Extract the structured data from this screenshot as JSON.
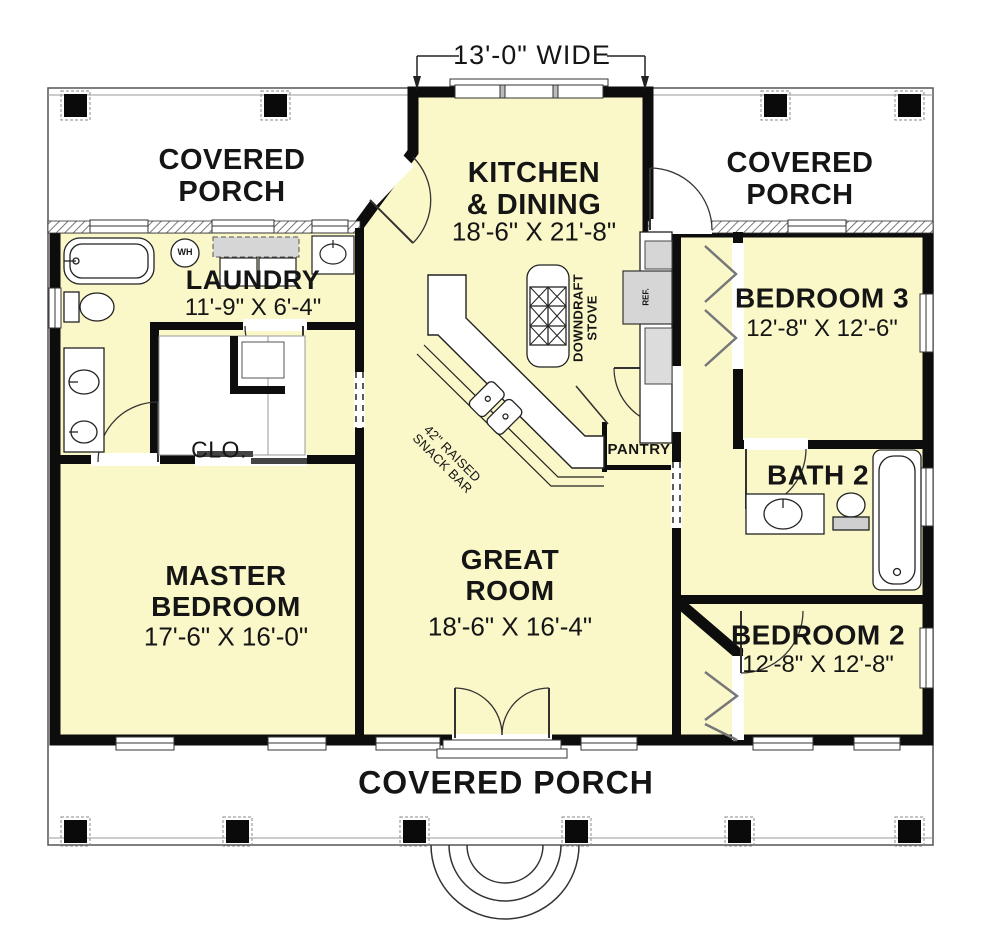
{
  "annotations": {
    "width_dimension": "13'-0\" WIDE",
    "downdraft_stove": "DOWNDRAFT\nSTOVE",
    "snack_bar": "42\" RAISED\nSNACK BAR",
    "water_heater": "WH",
    "refrigerator": "REF.",
    "closet": "CLO.",
    "pantry": "PANTRY"
  },
  "porches": {
    "top_left": "COVERED\nPORCH",
    "top_right": "COVERED\nPORCH",
    "bottom": "COVERED PORCH"
  },
  "rooms": {
    "kitchen": {
      "name": "KITCHEN\n& DINING",
      "dims": "18'-6\" X 21'-8\""
    },
    "laundry": {
      "name": "LAUNDRY",
      "dims": "11'-9\" X 6'-4\""
    },
    "bedroom3": {
      "name": "BEDROOM 3",
      "dims": "12'-8\" X 12'-6\""
    },
    "master": {
      "name": "MASTER\nBEDROOM",
      "dims": "17'-6\" X 16'-0\""
    },
    "great": {
      "name": "GREAT\nROOM",
      "dims": "18'-6\" X 16'-4\""
    },
    "bath2": {
      "name": "BATH 2"
    },
    "bedroom2": {
      "name": "BEDROOM 2",
      "dims": "12'-8\" X 12'-8\""
    }
  },
  "colors": {
    "room_fill": "#FAF8C9",
    "wall": "#0d0d0d",
    "appliance_gray": "#D6D6D6",
    "background": "#FFFFFF",
    "line": "#222222"
  }
}
